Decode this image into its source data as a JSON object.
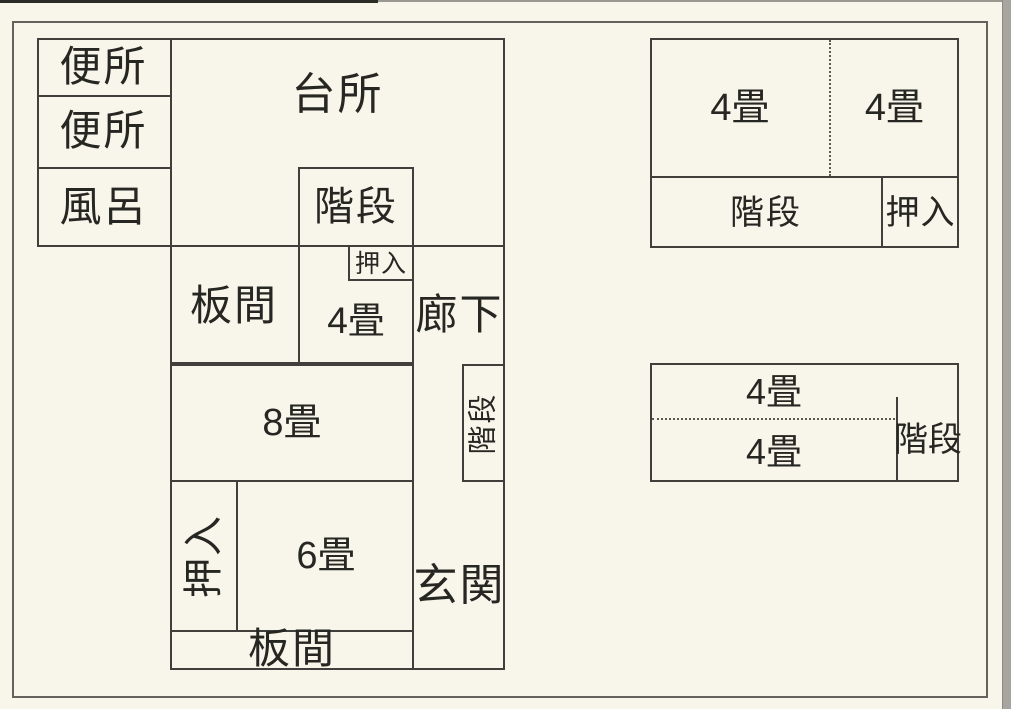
{
  "colors": {
    "paper_background": "#f8f5ea",
    "wall_line": "#403f3b",
    "outer_frame": "#63625d",
    "text": "#262622",
    "scan_edge_top": "#2b2b28",
    "scan_edge_right": "#a6a5a0"
  },
  "floor1": {
    "toilet_1": "便所",
    "toilet_2": "便所",
    "bath": "風呂",
    "kitchen": "台所",
    "stairs_upper": "階段",
    "closet_upper": "押入",
    "wood_room_middle": "板間",
    "tatami_4": "4畳",
    "corridor": "廊下",
    "tatami_8": "8畳",
    "stairs_lower": "階段",
    "closet_lower": "押入",
    "tatami_6": "6畳",
    "wood_room_bottom": "板間",
    "entrance": "玄関"
  },
  "floor2_north": {
    "tatami_4_left": "4畳",
    "tatami_4_right": "4畳",
    "stairs": "階段",
    "closet": "押入"
  },
  "floor2_south": {
    "tatami_4_upper": "4畳",
    "tatami_4_lower": "4畳",
    "stairs": "階段"
  }
}
